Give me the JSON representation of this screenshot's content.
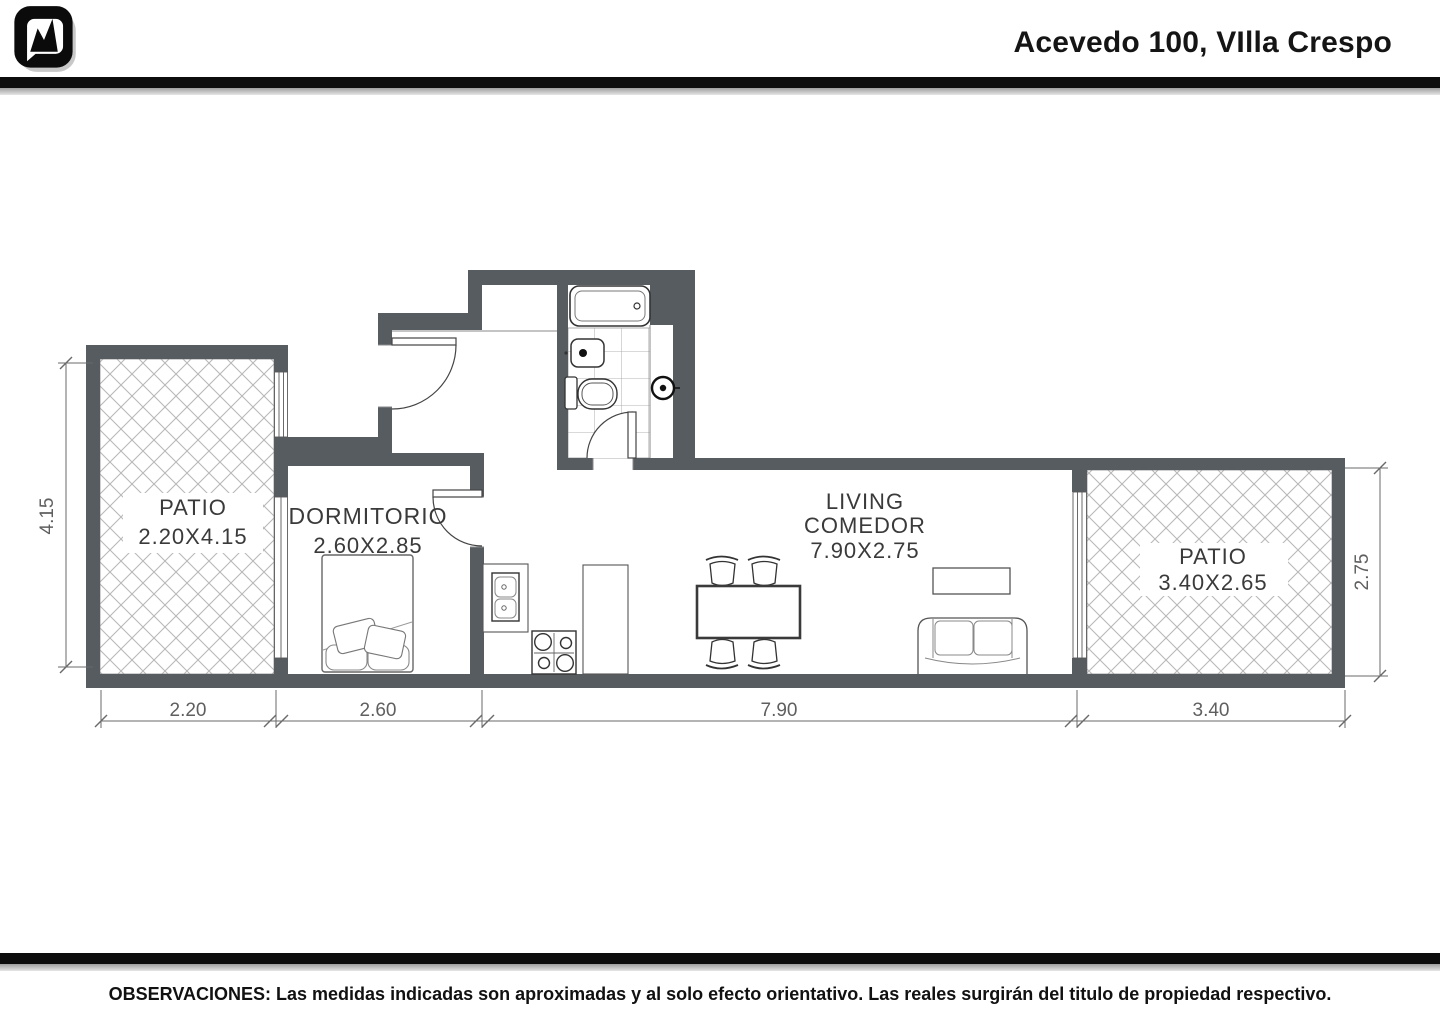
{
  "header": {
    "title": "Acevedo 100, VIlla Crespo"
  },
  "plan": {
    "rooms": [
      {
        "id": "patio-left",
        "name": "PATIO",
        "dims": "2.20X4.15"
      },
      {
        "id": "dormitorio",
        "name": "DORMITORIO",
        "dims": "2.60X2.85"
      },
      {
        "id": "living",
        "name": "LIVING",
        "name2": "COMEDOR",
        "dims": "7.90X2.75"
      },
      {
        "id": "patio-right",
        "name": "PATIO",
        "dims": "3.40X2.65"
      }
    ],
    "dimensions": {
      "bottom": [
        "2.20",
        "2.60",
        "7.90",
        "3.40"
      ],
      "left": "4.15",
      "right": "2.75"
    },
    "colors": {
      "wall": "#575c61",
      "hatch": "#b8b8b8",
      "dim": "#5f5f5f"
    }
  },
  "footer": {
    "observations": "OBSERVACIONES: Las medidas indicadas son aproximadas y al solo efecto orientativo. Las reales surgirán del titulo de propiedad respectivo."
  }
}
